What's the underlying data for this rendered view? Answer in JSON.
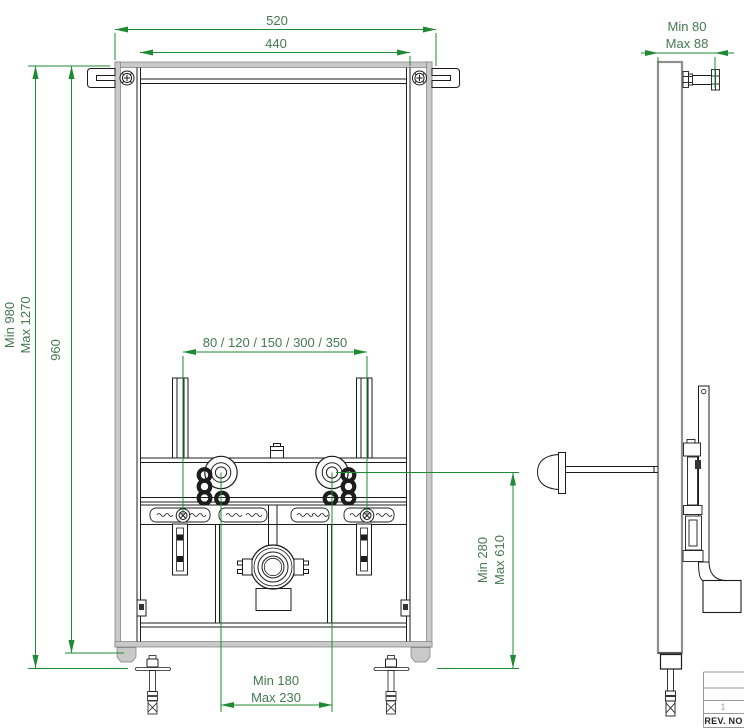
{
  "drawing": {
    "front_view": {
      "width_outer": "520",
      "width_inner": "440",
      "height_frame": "960",
      "height_min": "Min 980",
      "height_max": "Max 1270",
      "bracket_spacing": "80 / 120 / 150 / 300 / 350",
      "connection_height_min": "Min 280",
      "connection_height_max": "Max 610",
      "drain_distance_min": "Min 180",
      "drain_distance_max": "Max 230"
    },
    "side_view": {
      "depth_min": "Min 80",
      "depth_max": "Max 88"
    },
    "title_block": {
      "rev_value": "1",
      "rev_label": "REV. NO"
    },
    "colors": {
      "dimension_line": "#1f8a33",
      "dimension_text": "#447952",
      "frame_gray": "#c9c9c9",
      "frame_gray_edge": "#7d7d7d",
      "line_black": "#1c1c1c"
    }
  }
}
